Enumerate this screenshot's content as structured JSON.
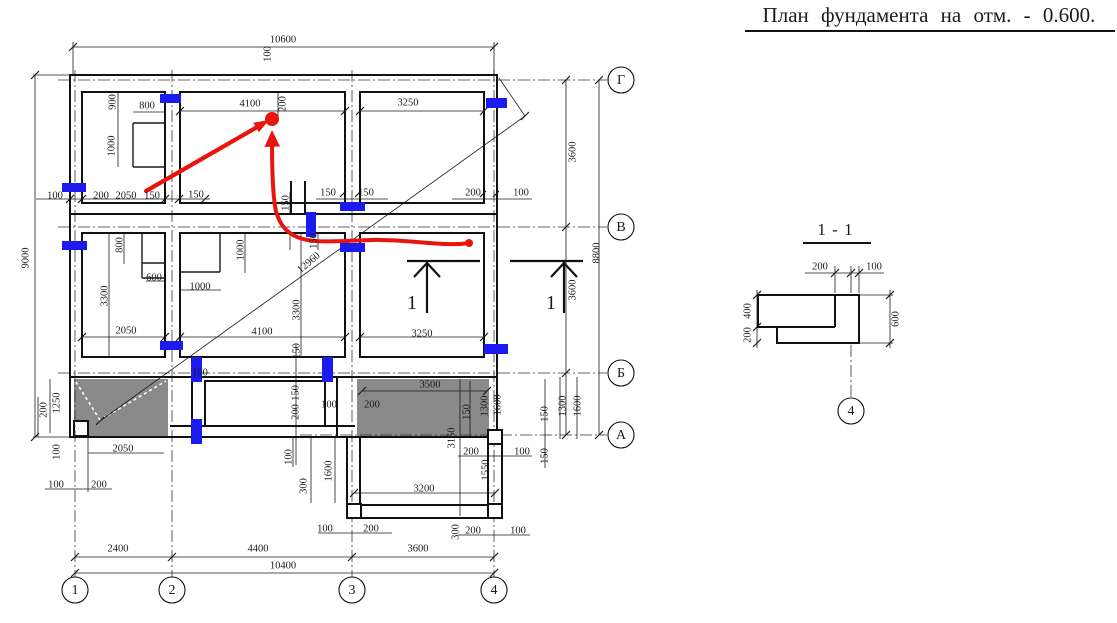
{
  "title": "План фундамента на отм. - 0.600.",
  "section_detail": {
    "title": "1 - 1",
    "axis_label": "4"
  },
  "section_markers": [
    {
      "label": "1",
      "x": 412,
      "y": 303
    },
    {
      "label": "1",
      "x": 551,
      "y": 303
    }
  ],
  "axes": {
    "bottom": [
      {
        "label": "1",
        "x": 75
      },
      {
        "label": "2",
        "x": 172
      },
      {
        "label": "3",
        "x": 352
      },
      {
        "label": "4",
        "x": 494
      }
    ],
    "right": [
      {
        "label": "Г",
        "y": 80
      },
      {
        "label": "В",
        "y": 227
      },
      {
        "label": "Б",
        "y": 373
      },
      {
        "label": "А",
        "y": 435
      }
    ]
  },
  "colors": {
    "annotation_red": "#e8150c",
    "mark_blue": "#1b1bf0",
    "porch_gray": "#8a8a8a"
  },
  "dims": [
    {
      "v": "10600",
      "x": 283,
      "y": 40,
      "r": 0
    },
    {
      "v": "100",
      "x": 268,
      "y": 54,
      "r": -90
    },
    {
      "v": "900",
      "x": 113,
      "y": 102,
      "r": -90
    },
    {
      "v": "800",
      "x": 147,
      "y": 106,
      "r": 0
    },
    {
      "v": "4100",
      "x": 250,
      "y": 104,
      "r": 0
    },
    {
      "v": "200",
      "x": 283,
      "y": 104,
      "r": -90
    },
    {
      "v": "3250",
      "x": 408,
      "y": 103,
      "r": 0
    },
    {
      "v": "1000",
      "x": 112,
      "y": 146,
      "r": -90
    },
    {
      "v": "100",
      "x": 55,
      "y": 196,
      "r": 0
    },
    {
      "v": "200",
      "x": 101,
      "y": 196,
      "r": 0
    },
    {
      "v": "2050",
      "x": 126,
      "y": 196,
      "r": 0
    },
    {
      "v": "150",
      "x": 152,
      "y": 196,
      "r": 0
    },
    {
      "v": "150",
      "x": 196,
      "y": 195,
      "r": 0
    },
    {
      "v": "150",
      "x": 328,
      "y": 193,
      "r": 0
    },
    {
      "v": "150",
      "x": 366,
      "y": 193,
      "r": 0
    },
    {
      "v": "200",
      "x": 473,
      "y": 193,
      "r": 0
    },
    {
      "v": "100",
      "x": 521,
      "y": 193,
      "r": 0
    },
    {
      "v": "150",
      "x": 286,
      "y": 203,
      "r": -90
    },
    {
      "v": "150",
      "x": 314,
      "y": 241,
      "r": -90
    },
    {
      "v": "800",
      "x": 120,
      "y": 245,
      "r": -90
    },
    {
      "v": "600",
      "x": 154,
      "y": 278,
      "r": 0
    },
    {
      "v": "3300",
      "x": 105,
      "y": 296,
      "r": -90
    },
    {
      "v": "1000",
      "x": 241,
      "y": 250,
      "r": -90
    },
    {
      "v": "1000",
      "x": 200,
      "y": 287,
      "r": 0
    },
    {
      "v": "2050",
      "x": 126,
      "y": 331,
      "r": 0
    },
    {
      "v": "4100",
      "x": 262,
      "y": 332,
      "r": 0
    },
    {
      "v": "3250",
      "x": 422,
      "y": 334,
      "r": 0
    },
    {
      "v": "3300",
      "x": 297,
      "y": 310,
      "r": -90
    },
    {
      "v": "12960",
      "x": 309,
      "y": 263,
      "r": -40
    },
    {
      "v": "150",
      "x": 297,
      "y": 351,
      "r": -90
    },
    {
      "v": "3600",
      "x": 573,
      "y": 152,
      "r": -90
    },
    {
      "v": "8800",
      "x": 597,
      "y": 253,
      "r": -90
    },
    {
      "v": "3600",
      "x": 573,
      "y": 290,
      "r": -90
    },
    {
      "v": "1300",
      "x": 563,
      "y": 406,
      "r": -90
    },
    {
      "v": "1600",
      "x": 578,
      "y": 406,
      "r": -90
    },
    {
      "v": "150",
      "x": 545,
      "y": 414,
      "r": -90
    },
    {
      "v": "150",
      "x": 545,
      "y": 456,
      "r": -90
    },
    {
      "v": "150",
      "x": 467,
      "y": 412,
      "r": -90
    },
    {
      "v": "1300",
      "x": 485,
      "y": 406,
      "r": -90
    },
    {
      "v": "1600",
      "x": 498,
      "y": 405,
      "r": -90
    },
    {
      "v": "1550",
      "x": 486,
      "y": 470,
      "r": -90
    },
    {
      "v": "1250",
      "x": 57,
      "y": 403,
      "r": -90
    },
    {
      "v": "200",
      "x": 44,
      "y": 410,
      "r": -90
    },
    {
      "v": "100",
      "x": 57,
      "y": 452,
      "r": -90
    },
    {
      "v": "2050",
      "x": 123,
      "y": 449,
      "r": 0
    },
    {
      "v": "100",
      "x": 56,
      "y": 485,
      "r": 0
    },
    {
      "v": "200",
      "x": 99,
      "y": 485,
      "r": 0
    },
    {
      "v": "100",
      "x": 200,
      "y": 373,
      "r": 0
    },
    {
      "v": "100",
      "x": 329,
      "y": 405,
      "r": 0
    },
    {
      "v": "200",
      "x": 372,
      "y": 405,
      "r": 0
    },
    {
      "v": "3500",
      "x": 430,
      "y": 385,
      "r": 0
    },
    {
      "v": "3150",
      "x": 452,
      "y": 438,
      "r": -90
    },
    {
      "v": "200",
      "x": 471,
      "y": 452,
      "r": 0
    },
    {
      "v": "100",
      "x": 522,
      "y": 452,
      "r": 0
    },
    {
      "v": "150",
      "x": 296,
      "y": 393,
      "r": -90
    },
    {
      "v": "200",
      "x": 296,
      "y": 412,
      "r": -90
    },
    {
      "v": "100",
      "x": 289,
      "y": 457,
      "r": -90
    },
    {
      "v": "300",
      "x": 304,
      "y": 486,
      "r": -90
    },
    {
      "v": "1600",
      "x": 329,
      "y": 471,
      "r": -90
    },
    {
      "v": "3200",
      "x": 424,
      "y": 489,
      "r": 0
    },
    {
      "v": "100",
      "x": 325,
      "y": 529,
      "r": 0
    },
    {
      "v": "200",
      "x": 371,
      "y": 529,
      "r": 0
    },
    {
      "v": "300",
      "x": 456,
      "y": 532,
      "r": -90
    },
    {
      "v": "200",
      "x": 473,
      "y": 531,
      "r": 0
    },
    {
      "v": "100",
      "x": 518,
      "y": 531,
      "r": 0
    },
    {
      "v": "2400",
      "x": 118,
      "y": 549,
      "r": 0
    },
    {
      "v": "4400",
      "x": 258,
      "y": 549,
      "r": 0
    },
    {
      "v": "3600",
      "x": 418,
      "y": 549,
      "r": 0
    },
    {
      "v": "10400",
      "x": 283,
      "y": 566,
      "r": 0
    },
    {
      "v": "9000",
      "x": 26,
      "y": 258,
      "r": -90
    },
    {
      "v": "200",
      "x": 820,
      "y": 267,
      "r": 0
    },
    {
      "v": "100",
      "x": 874,
      "y": 267,
      "r": 0
    },
    {
      "v": "400",
      "x": 748,
      "y": 311,
      "r": -90
    },
    {
      "v": "200",
      "x": 748,
      "y": 335,
      "r": -90
    },
    {
      "v": "600",
      "x": 896,
      "y": 319,
      "r": -90
    }
  ],
  "blue_marks": [
    {
      "x": 160,
      "y": 94,
      "w": 21,
      "h": 9
    },
    {
      "x": 486,
      "y": 98,
      "w": 21,
      "h": 10
    },
    {
      "x": 62,
      "y": 183,
      "w": 24,
      "h": 9
    },
    {
      "x": 62,
      "y": 241,
      "w": 25,
      "h": 9
    },
    {
      "x": 340,
      "y": 202,
      "w": 25,
      "h": 9
    },
    {
      "x": 340,
      "y": 243,
      "w": 25,
      "h": 9
    },
    {
      "x": 484,
      "y": 344,
      "w": 24,
      "h": 10
    },
    {
      "x": 160,
      "y": 341,
      "w": 23,
      "h": 9
    },
    {
      "x": 306,
      "y": 212,
      "w": 10,
      "h": 25
    },
    {
      "x": 191,
      "y": 357,
      "w": 11,
      "h": 25
    },
    {
      "x": 191,
      "y": 419,
      "w": 11,
      "h": 25
    },
    {
      "x": 322,
      "y": 357,
      "w": 11,
      "h": 25
    }
  ]
}
